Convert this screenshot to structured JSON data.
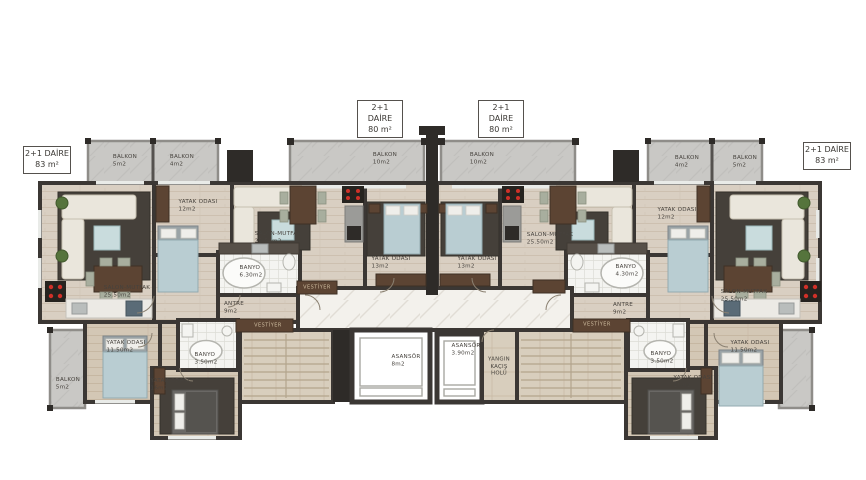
{
  "unit_labels": [
    {
      "title": "2+1 DAİRE",
      "area": "83 m²",
      "x": 23,
      "y": 146,
      "w": 44
    },
    {
      "title": "2+1 DAİRE",
      "area": "80 m²",
      "x": 357,
      "y": 100,
      "w": 42
    },
    {
      "title": "2+1 DAİRE",
      "area": "80 m²",
      "x": 478,
      "y": 100,
      "w": 42
    },
    {
      "title": "2+1 DAİRE",
      "area": "83 m²",
      "x": 803,
      "y": 142,
      "w": 44
    }
  ],
  "labels": [
    {
      "text": "BALKON",
      "area": "5m2",
      "x": 125,
      "y": 161
    },
    {
      "text": "BALKON",
      "area": "4m2",
      "x": 182,
      "y": 161
    },
    {
      "text": "BALKON",
      "area": "10m2",
      "x": 385,
      "y": 159
    },
    {
      "text": "BALKON",
      "area": "10m2",
      "x": 482,
      "y": 159
    },
    {
      "text": "BALKON",
      "area": "4m2",
      "x": 687,
      "y": 162
    },
    {
      "text": "BALKON",
      "area": "5m2",
      "x": 745,
      "y": 162
    },
    {
      "text": "YATAK ODASI",
      "area": "12m2",
      "x": 198,
      "y": 206
    },
    {
      "text": "YATAK ODASI",
      "area": "12m2",
      "x": 677,
      "y": 214
    },
    {
      "text": "SALON-MUTFAK",
      "area": "25.50m2",
      "x": 127,
      "y": 292
    },
    {
      "text": "SALON-MUTFAK",
      "area": "25.50m2",
      "x": 278,
      "y": 238
    },
    {
      "text": "SALON-MUTFAK",
      "area": "25.50m2",
      "x": 550,
      "y": 239
    },
    {
      "text": "SALON-MUTFAK",
      "area": "25.50m2",
      "x": 744,
      "y": 296
    },
    {
      "text": "BANYO",
      "area": "6.30m2",
      "x": 251,
      "y": 272
    },
    {
      "text": "BANYO",
      "area": "4.30m2",
      "x": 627,
      "y": 271
    },
    {
      "text": "YATAK ODASI",
      "area": "13m2",
      "x": 391,
      "y": 263
    },
    {
      "text": "YATAK ODASI",
      "area": "13m2",
      "x": 477,
      "y": 263
    },
    {
      "text": "ANTRE",
      "area": "9m2",
      "x": 234,
      "y": 308
    },
    {
      "text": "ANTRE",
      "area": "9m2",
      "x": 623,
      "y": 309
    },
    {
      "text": "VESTİYER",
      "x": 317,
      "y": 288,
      "variant": "cabinet"
    },
    {
      "text": "VESTİYER",
      "x": 268,
      "y": 326,
      "variant": "cabinet"
    },
    {
      "text": "VESTİYER",
      "x": 597,
      "y": 325,
      "variant": "cabinet"
    },
    {
      "text": "YATAK ODASI",
      "area": "11.50m2",
      "x": 126,
      "y": 347
    },
    {
      "text": "YATAK ODASI",
      "area": "16m2",
      "x": 170,
      "y": 385
    },
    {
      "text": "BANYO",
      "area": "3.50m2",
      "x": 206,
      "y": 359
    },
    {
      "text": "BANYO",
      "area": "3.50m2",
      "x": 662,
      "y": 358
    },
    {
      "text": "YATAK ODASI",
      "area": "16m2",
      "x": 693,
      "y": 382
    },
    {
      "text": "YATAK ODASI",
      "area": "11.50m2",
      "x": 750,
      "y": 347
    },
    {
      "text": "BALKON",
      "area": "5m2",
      "x": 68,
      "y": 384
    },
    {
      "text": "ASANSÖR",
      "area": "8m2",
      "x": 406,
      "y": 361
    },
    {
      "text": "ASANSÖR",
      "area": "3.90m2",
      "x": 466,
      "y": 350
    },
    {
      "text": "YANGIN KAÇIŞ HOLÜ",
      "x": 499,
      "y": 367,
      "variant": "wrap"
    }
  ],
  "colors": {
    "wall": "#3b3734",
    "wall_dark": "#2e2b28",
    "wood": "#d9cfc2",
    "wood_line": "#c9bcab",
    "wood_dark": "#d3c7b5",
    "balcony": "#c9c8c5",
    "marble": "#f3f1ec",
    "tile": "#f4f4f1",
    "stone": "#d8cebd",
    "rug": "#45403a",
    "sofa_cream": "#eae6dc",
    "bed_teal": "#b9cdd2",
    "furniture_brown": "#5c4433",
    "burner_red": "#d03028",
    "label_text": "#46423d",
    "cabinet_text": "#cdbb9e"
  }
}
